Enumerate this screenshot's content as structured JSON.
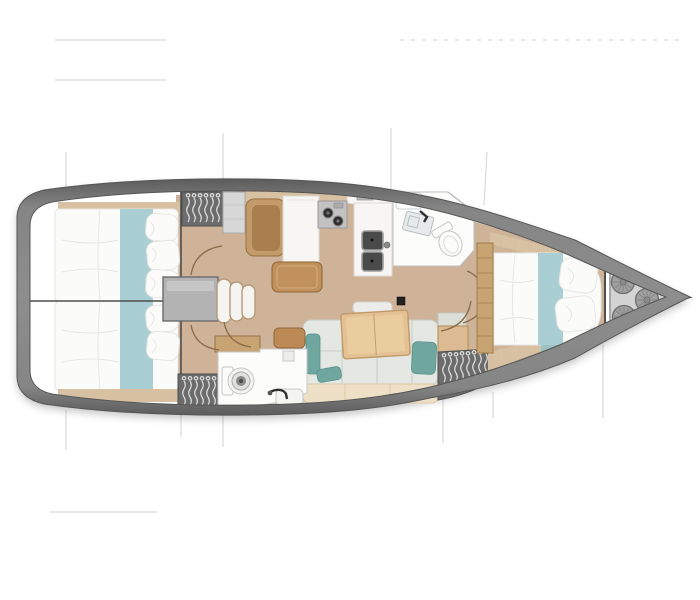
{
  "title": "sailing-yacht-interior-floor-plan-top-view",
  "canvas": {
    "width": 700,
    "height": 600,
    "background": "#ffffff"
  },
  "colors": {
    "canvas_bg": "#ffffff",
    "hull_band_dark": "#5c5c5c",
    "hull_band_mid": "#848484",
    "hull_edge": "#565656",
    "floor_wood": "#cfb399",
    "deck_plank": "#f0e6d2",
    "plank_seam": "#d8c6a8",
    "trim_wood": "#d8c0a2",
    "shelf_wood": "#c7a472",
    "shelf_trim": "#9f7c48",
    "bed_linen": "#fbfbfa",
    "linen_shadow": "#e6e6e2",
    "runner_teal": "#a9ced3",
    "runner_teal_deep": "#9cc3c8",
    "wardrobe": "#6c6c6c",
    "wardrobe_edge": "#4e4e4e",
    "hanger": "#e0e0e0",
    "cabinet_gray": "#d7d7d7",
    "engine_gray": "#b3b3b3",
    "step_trim": "#b49a78",
    "seat_brown": "#aa7f50",
    "seat_trim": "#c39a69",
    "tray_wood": "#c0915c",
    "tray_trim": "#8e6435",
    "counter": "#f7f6f4",
    "counter_line": "#ddd9d2",
    "cooktop": "#c2c2c2",
    "burner_dark": "#2e2e2e",
    "sink_dark": "#4a4a4a",
    "sofa": "#e4e7e2",
    "sofa_seam": "#c7cdc5",
    "teal_pillow": "#6fa6a0",
    "teal_pillow_edge": "#57918b",
    "seat_base": "#eee0c6",
    "seat_base_trim": "#dcc9a6",
    "table_wood": "#e3c194",
    "table_inner": "#eacd9f",
    "table_trim": "#c09a68",
    "bar_light": "#ececе9",
    "bar_fill": "#ececeб",
    "mast": "#222222",
    "locker_gray": "#d3d3d3",
    "locker_edge": "#989898",
    "fender": "#a0a0a0",
    "fender_line": "#6f6f6f",
    "bow_tip": "#4f4f4f",
    "door_arc": "#8a6a46",
    "wall": "#4e4e4e",
    "section_line": "#d2d2d2",
    "room_white": "#fcfcfb",
    "fixture_line": "#c6c6c6",
    "faucet": "#303030"
  },
  "areas": [
    {
      "id": "aft-cabin-port",
      "label": "aft double cabin (top)"
    },
    {
      "id": "aft-cabin-starboard",
      "label": "aft double cabin (bottom)"
    },
    {
      "id": "companionway",
      "label": "companionway steps / engine box"
    },
    {
      "id": "nav-station",
      "label": "nav seat and chart table"
    },
    {
      "id": "galley",
      "label": "galley with stove and twin sinks"
    },
    {
      "id": "head-forward",
      "label": "forward head with toilet and vanity"
    },
    {
      "id": "salon",
      "label": "salon with table and L-sofa"
    },
    {
      "id": "head-aft",
      "label": "aft head with toilet and sink"
    },
    {
      "id": "forward-cabin",
      "label": "forward owner cabin"
    },
    {
      "id": "bow-locker",
      "label": "bow sail locker with fender bags"
    }
  ],
  "icons": [
    "hanger-icon",
    "toilet-icon",
    "sink-icon",
    "stove-icon",
    "fender-bag-icon",
    "mast-post-icon",
    "door-swing-icon"
  ]
}
